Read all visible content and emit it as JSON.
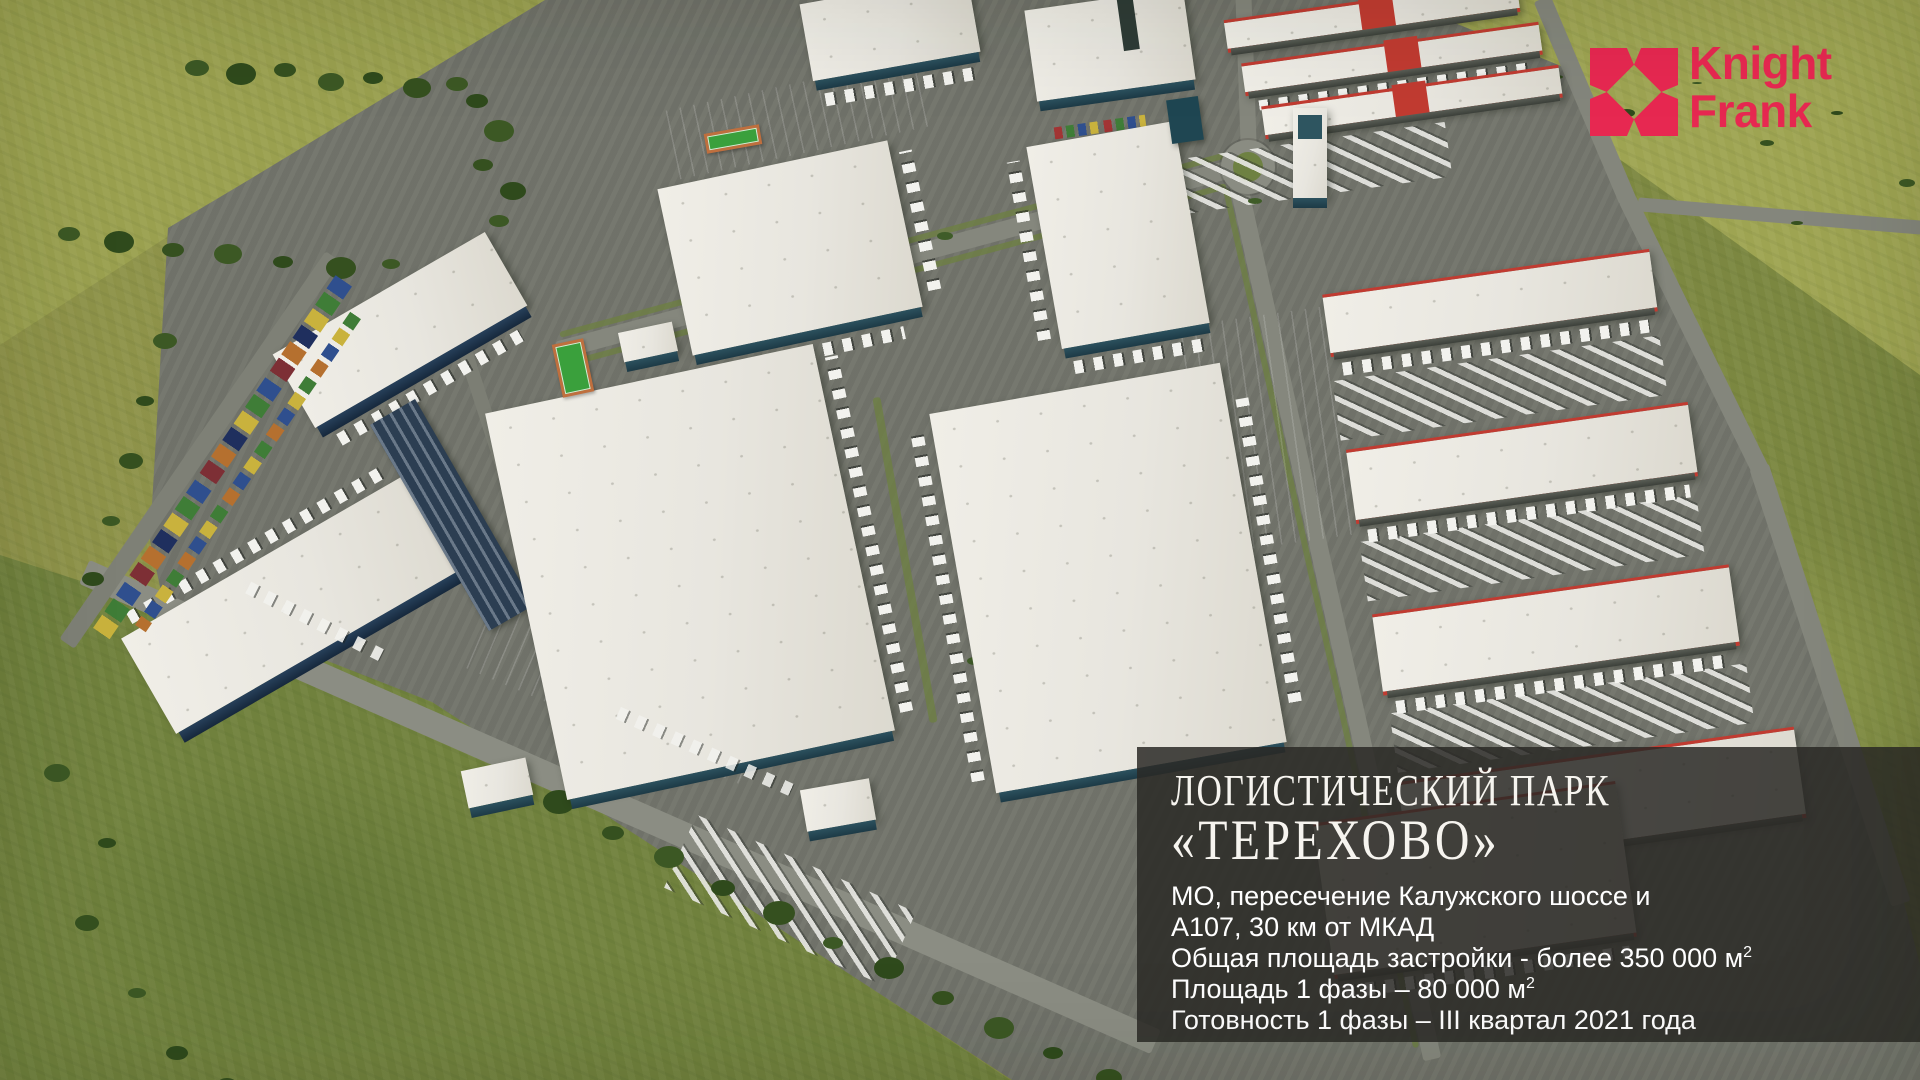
{
  "logo": {
    "name": "Knight Frank",
    "line1": "Knight",
    "line2": "Frank",
    "brand_color": "#e72851",
    "mark": "knight-frank-pinwheel-mark-icon"
  },
  "info_panel": {
    "title_line1": "ЛОГИСТИЧЕСКИЙ ПАРК",
    "title_line2": "«ТЕРЕХОВО»",
    "details": [
      {
        "text": "МО, пересечение Калужского шоссе и"
      },
      {
        "text": "А107, 30 км от МКАД"
      },
      {
        "text": "Общая площадь застройки - более 350 000 м",
        "sup": "2"
      },
      {
        "text": "Площадь 1 фазы – 80 000 м",
        "sup": "2"
      },
      {
        "text": "Готовность 1 фазы – III квартал 2021 года"
      }
    ],
    "panel_color": "rgba(42,41,38,0.85)",
    "text_color": "#ffffff"
  },
  "scene": {
    "description": "Aerial 3D render of a logistics park: white flat-roof warehouses with loading docks and trucks, red-trimmed terminals, rows of colored containers, access roads, tennis courts, roundabout, surrounded by green fields and trees",
    "colors": {
      "grass": "#89904a",
      "trees": "#35501f",
      "asphalt": "#73756c",
      "roof_white": "#e8e6df",
      "roof_trim_red": "#c13b31",
      "building_side_teal": "#2c515e"
    }
  }
}
